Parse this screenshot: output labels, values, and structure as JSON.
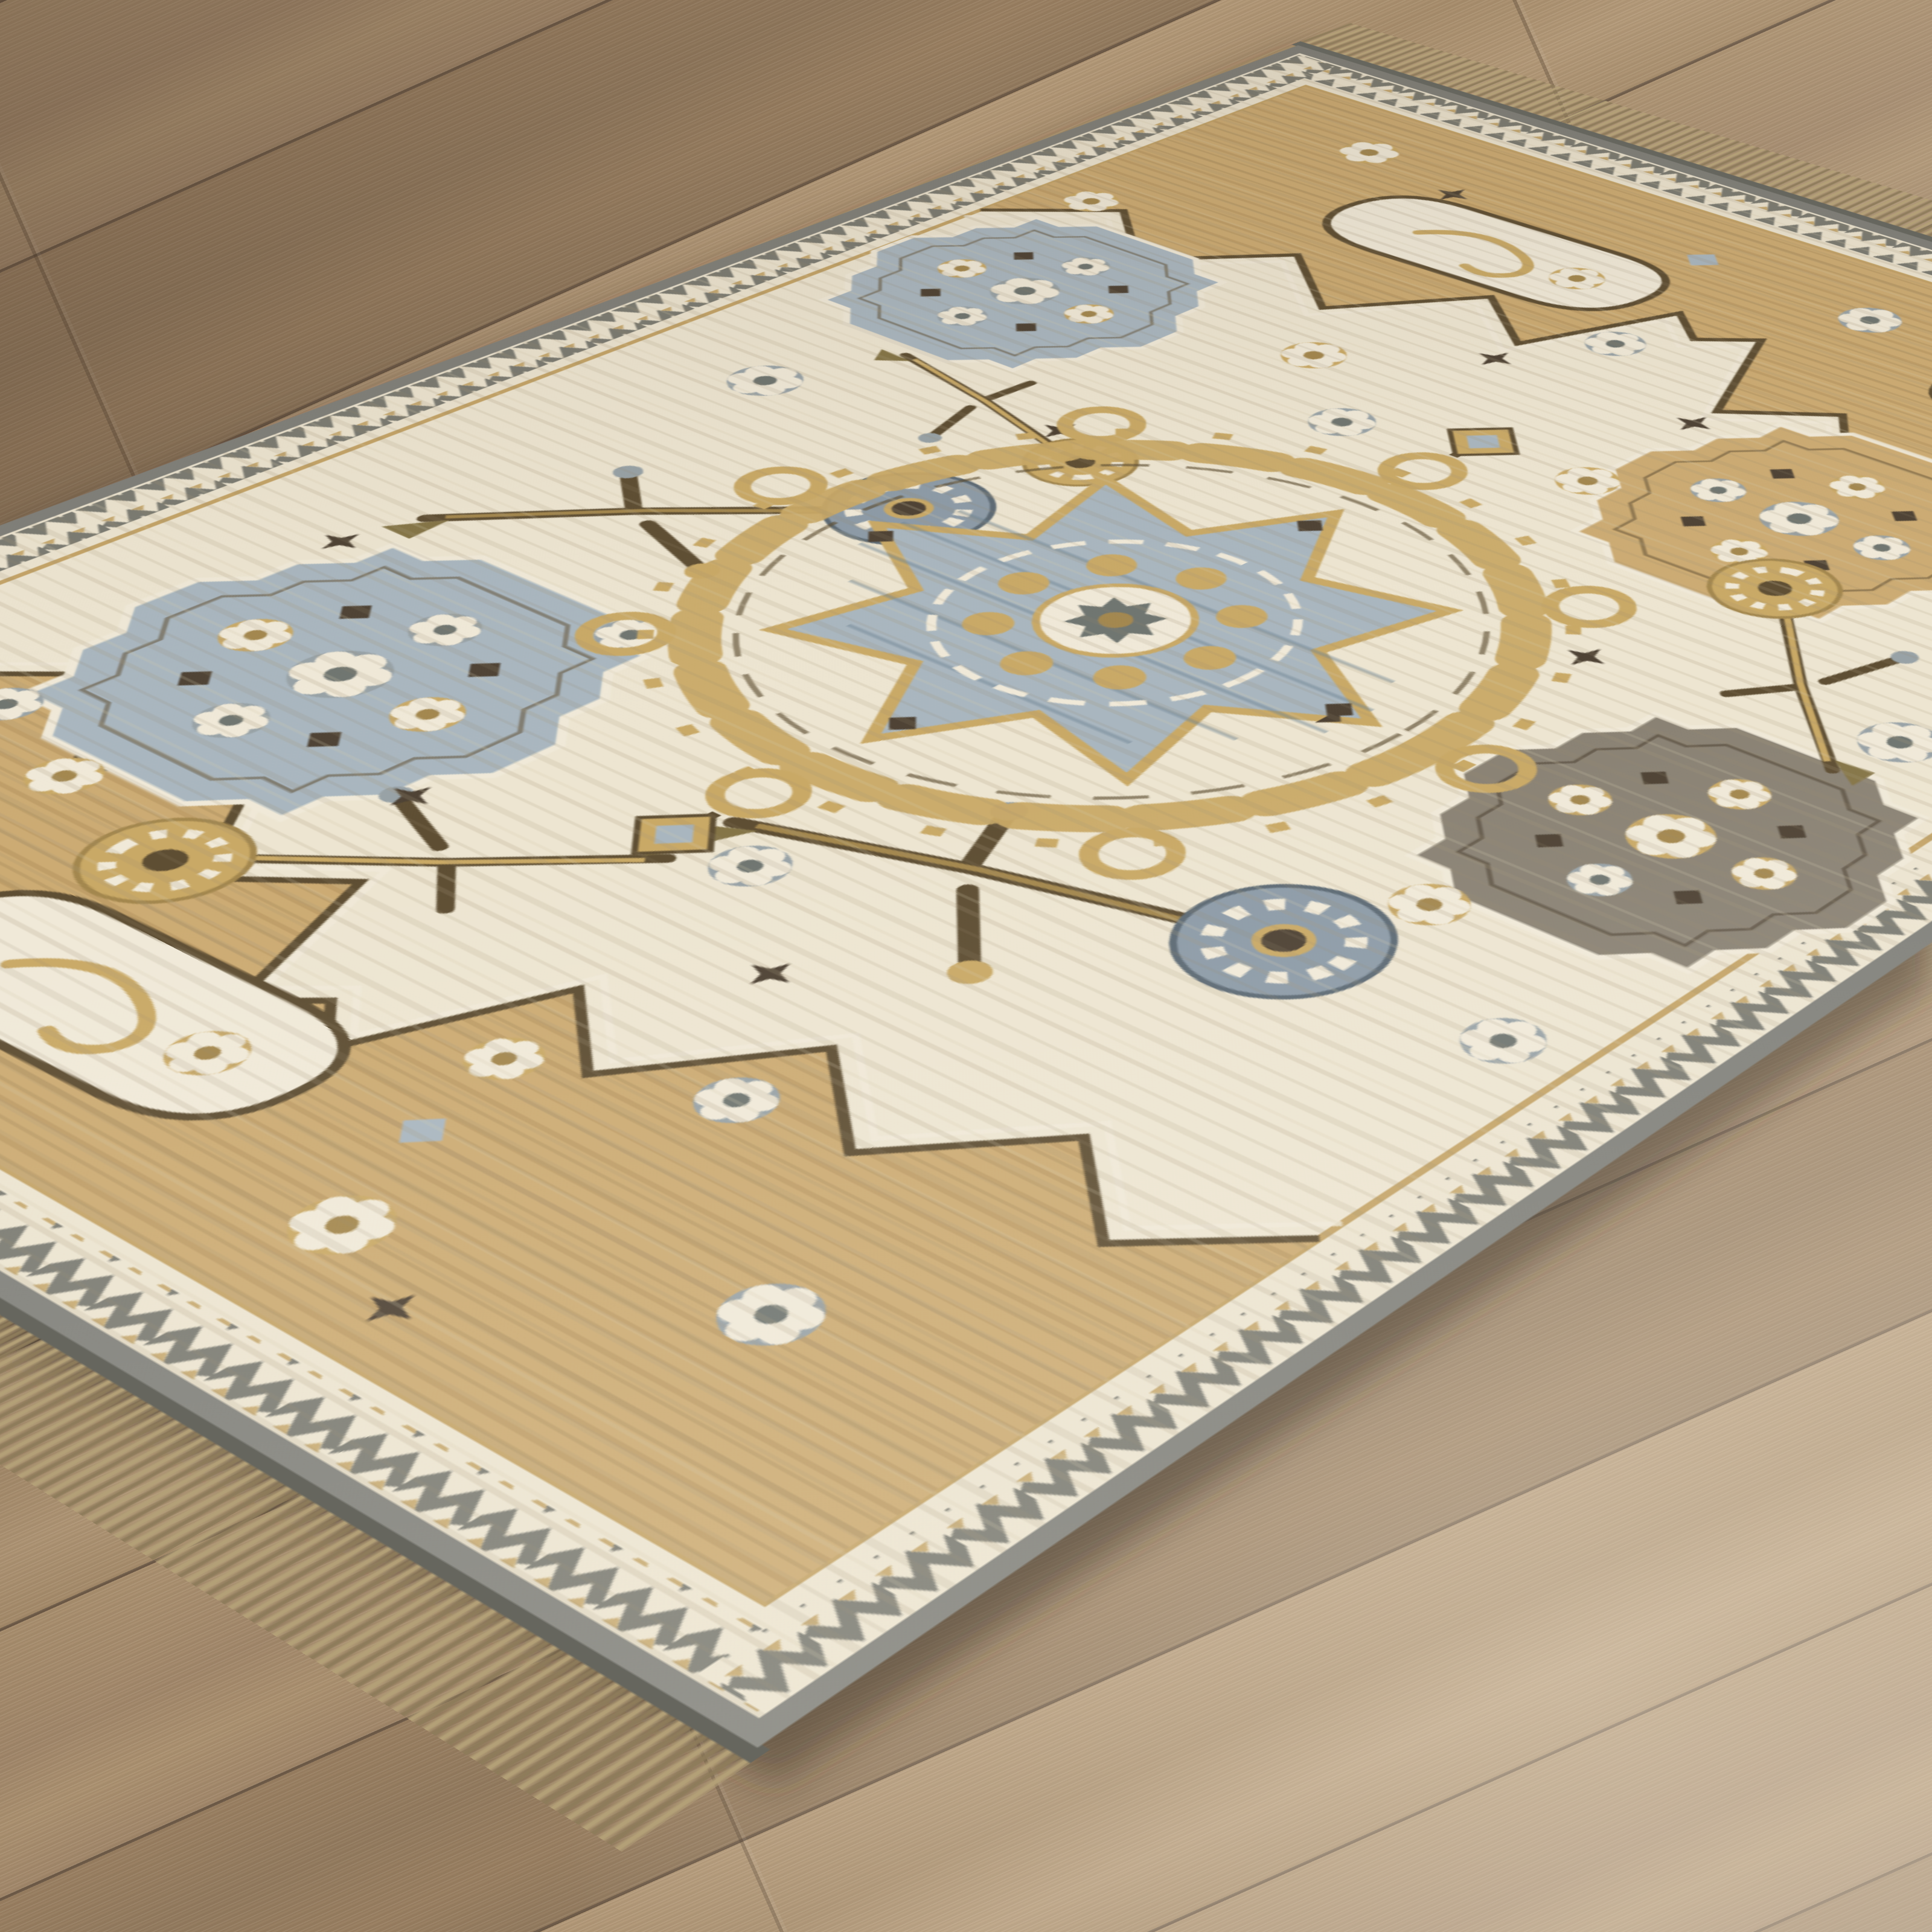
{
  "meta": {
    "title": "Traditional Oushak-style medallion area rug photographed diagonally on a wood plank floor"
  },
  "scene": {
    "setting": "interior room floor, product-style photograph, no text or UI elements",
    "camera_angle": "high three-quarter angle; rug rotated diagonally with wood floor visible in top-left, top-right and bottom-right corners",
    "lighting": "soft daylight, brighter toward lower-right, slight shade at upper-left",
    "objects": {
      "floor": {
        "label": "wood plank flooring",
        "description": "warm brown wood-look planks laid diagonally (rising to the right), grain streaks along planks, lighter gray-beige sheen toward lower right"
      },
      "rug": {
        "label": "traditional area rug",
        "style": "Oushak / tribal medallion rug",
        "parts": {
          "field": "ivory ground with faint weft striations and scattered angular floral sprays, rosettes and star accents",
          "medallion": "central eight-point star medallion in light blue-gray with gold scroll ring, ivory center rosette and diamond pendants",
          "clusters": "stepped octagon flower clusters in blue-gray, gold-tan and dark taupe scattered in the field",
          "end_panels": "tan spandrel panels at both rug ends with zigzag brown boundary, ivory scroll cartouches and rosettes",
          "guard_border": "ivory band with gray zigzag ribbon and small tan accents around the whole rug",
          "binding": "gray overcast edge binding along all edges",
          "fringe": "tan knotted fringe along the two short ends"
        }
      },
      "shadow": "soft dark shadow cast by rug edges onto floor, strongest at lower edges"
    }
  },
  "palette": {
    "floor_base": "#a08767",
    "floor_seam": "#6b5845",
    "plank_a": "#ab9170",
    "plank_b": "#a1876a",
    "plank_c": "#997f61",
    "plank_d": "#927a5e",
    "plank_e": "#b29877",
    "plank_f": "#a78d6c",
    "floor_light": "rgba(244,233,215,0.34)",
    "floor_shade": "rgba(70,52,38,0.30)",
    "rug_shadow": "rgba(55,42,30,0.45)",
    "binding_gray": "#80807a",
    "binding_dark": "#66665e",
    "guard_ivory": "#ece4d0",
    "zigzag_gray": "#7b7b72",
    "accent_tan": "#c4a468",
    "field_ivory": "#ede5d1",
    "panel_tan": "#ccab73",
    "panel_stripe": "rgba(146,113,62,0.22)",
    "outline_brown": "#5e4e33",
    "ivory": "#f0e9d8",
    "gold": "#c9a966",
    "gold_deep": "#a3874e",
    "blue": "#a9b6bf",
    "blue_deep": "#8d9ba7",
    "slate": "#6f7570",
    "gray_motif": "#98a2a6",
    "dark": "#4e4234",
    "olive": "#857547",
    "cluster_dark": "#8a8274",
    "fringe": "#b3a077",
    "fringe_dark": "#8d7b5a",
    "stria": "rgba(164,148,120,0.20)",
    "stria2": "rgba(150,132,104,0.14)"
  }
}
